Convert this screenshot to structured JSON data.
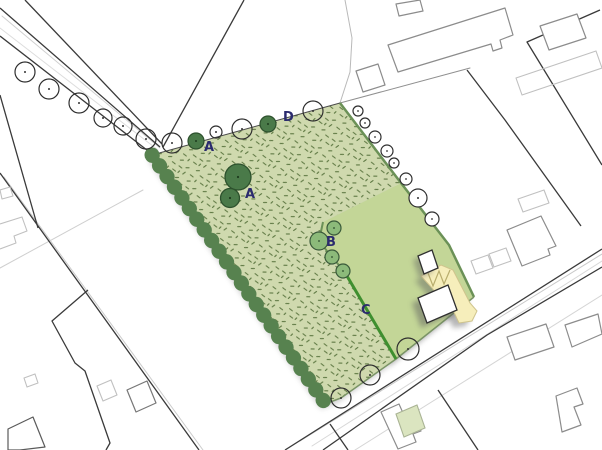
{
  "map": {
    "plan_labels": {
      "tree_a_top": "A",
      "tree_a_mid": "A",
      "shrub_b": "B",
      "hedge_c": "C",
      "tree_d": "D"
    },
    "colors": {
      "meadow": "#cfd9ae",
      "meadow_speckle": "#57723c",
      "lawn": "#c3d697",
      "hedge": "#5e8a57",
      "edge_green": "#6b9157",
      "tree_dark": "#4a7a49",
      "tree_dark_stroke": "#2d512d",
      "shrub_green": "#8cba7a",
      "hedge_line_green": "#3f8f2f",
      "building_yellow": "#f6eebb",
      "building_yellow_stroke": "#cfc48d",
      "label_ink": "#2b2b6e",
      "line_dark": "#3a3a3a",
      "building_gray": "#8c8c8c"
    }
  }
}
